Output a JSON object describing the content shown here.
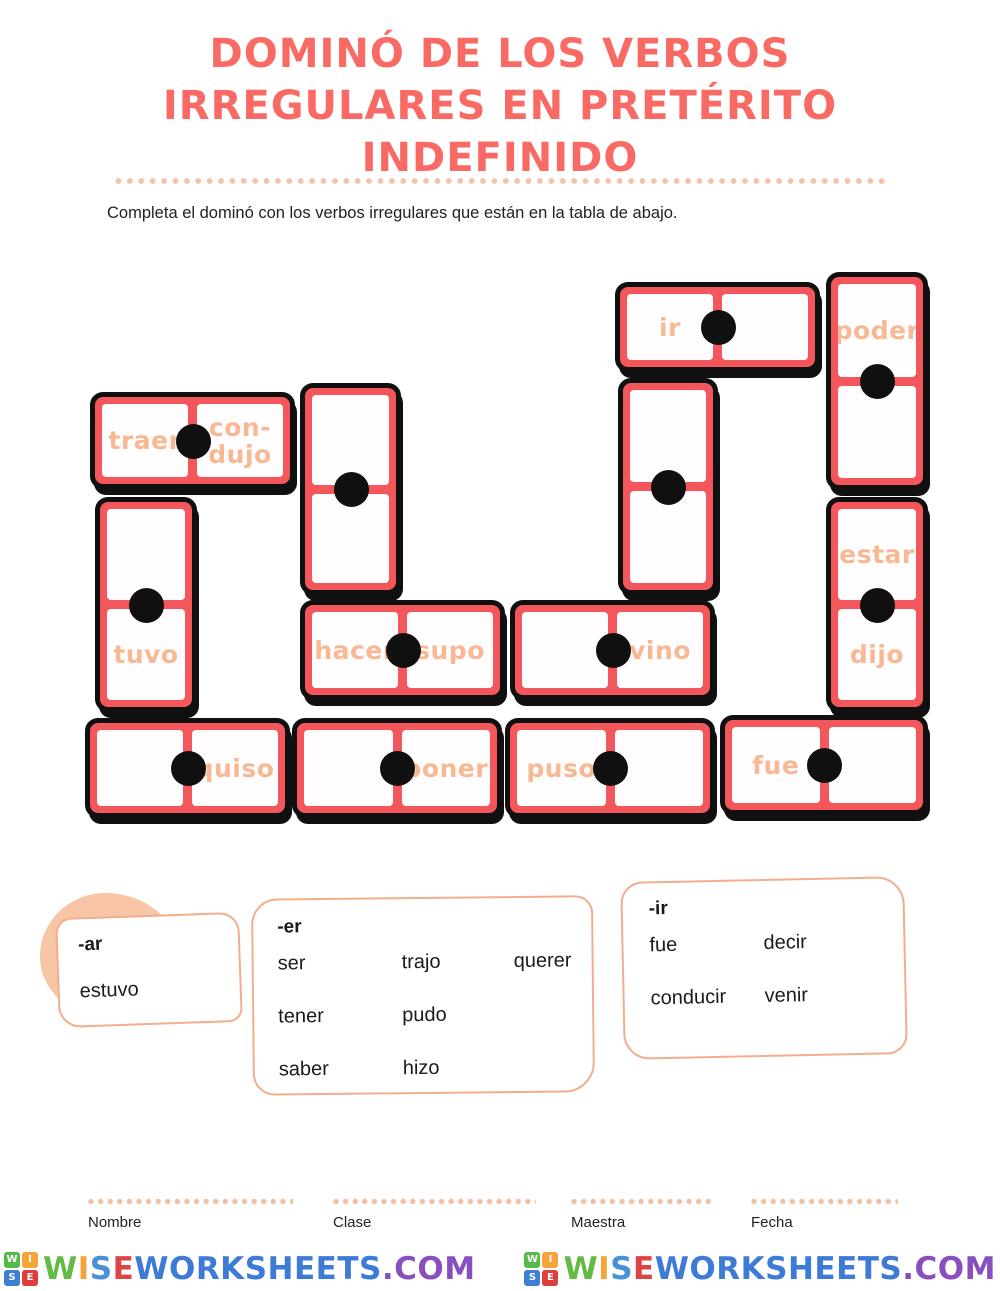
{
  "header": {
    "title_lines": [
      "DOMINÓ DE LOS VERBOS",
      "IRREGULARES EN PRETÉRITO",
      "INDEFINIDO"
    ],
    "instruction": "Completa el dominó con los verbos irregulares que están en la tabla de abajo."
  },
  "board": {
    "tiles": [
      {
        "a": "ir",
        "b": ""
      },
      {
        "a": "poder",
        "b": ""
      },
      {
        "a": "traer",
        "b": "con-\ndujo"
      },
      {
        "a": "",
        "b": ""
      },
      {
        "a": "",
        "b": ""
      },
      {
        "a": "",
        "b": "tuvo"
      },
      {
        "a": "hacer",
        "b": "supo"
      },
      {
        "a": "",
        "b": "vino"
      },
      {
        "a": "estar",
        "b": "dijo"
      },
      {
        "a": "",
        "b": "quiso"
      },
      {
        "a": "",
        "b": "poner"
      },
      {
        "a": "puso",
        "b": ""
      },
      {
        "a": "fue",
        "b": ""
      }
    ]
  },
  "word_bank": {
    "groups": [
      {
        "label": "-ar",
        "words": [
          "estuvo"
        ]
      },
      {
        "label": "-er",
        "words": [
          "ser",
          "trajo",
          "querer",
          "tener",
          "pudo",
          "saber",
          "hizo"
        ]
      },
      {
        "label": "-ir",
        "words": [
          "fue",
          "decir",
          "conducir",
          "venir"
        ]
      }
    ]
  },
  "footer": {
    "fields": [
      "Nombre",
      "Clase",
      "Maestra",
      "Fecha"
    ],
    "brand": {
      "grid_letters": [
        "W",
        "I",
        "S",
        "E"
      ],
      "grid_colors": [
        "#57b94c",
        "#f5a43b",
        "#3f7fd1",
        "#e03d3d"
      ],
      "segments": [
        {
          "text": "W",
          "color": "#63bb46"
        },
        {
          "text": "I",
          "color": "#f5a43b"
        },
        {
          "text": "S",
          "color": "#4a90d9"
        },
        {
          "text": "E",
          "color": "#e04343"
        },
        {
          "text": "WORKSHEETS",
          "color": "#3e7bd6"
        },
        {
          "text": ".COM",
          "color": "#8a4fbf"
        }
      ]
    }
  },
  "colors": {
    "domino_frame": "#f4575b",
    "domino_border": "#101010",
    "verb_text": "#f8b893",
    "title": "#fa6a65",
    "dots": "#f3c2a9",
    "bank_border": "#f2ae8c",
    "blob": "#f8c5a6"
  }
}
